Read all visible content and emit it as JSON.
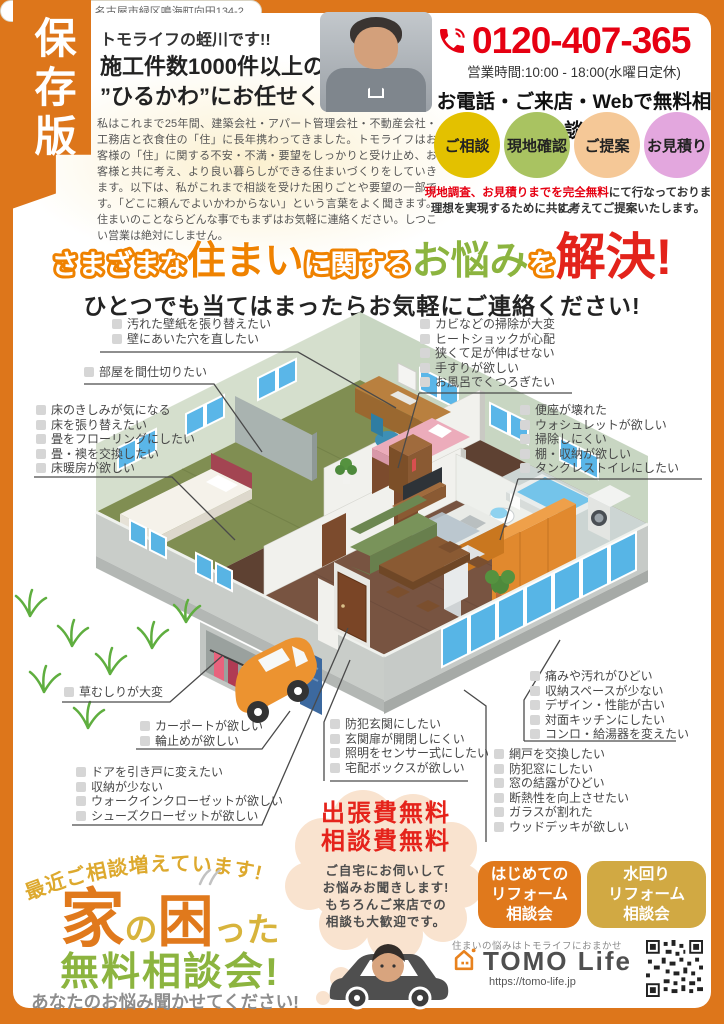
{
  "frame": {
    "save_label": "保存版"
  },
  "header": {
    "greeting": "トモライフの蛭川です!!",
    "headline_line1": "施工件数1000件以上の",
    "headline_line2": "”ひるかわ”にお任せください。",
    "paragraph": "私はこれまで25年間、建築会社・アパート管理会社・不動産会社・工務店と衣食住の「住」に長年携わってきました。トモライフはお客様の「住」に関する不安・不満・要望をしっかりと受け止め、お客様と共に考え、より良い暮らしができる住まいづくりをしていきます。以下は、私がこれまで相談を受けた困りごとや要望の一部です。「どこに頼んでよいかわからない」という言葉をよく聞きます。住まいのことならどんな事でもまずはお気軽に連絡ください。しつこい営業は絶対にしません。",
    "phone": "0120-407-365",
    "hours": "営業時間:10:00 - 18:00(水曜日定休)",
    "free_consult": "お電話・ご来店・Webで無料相談",
    "steps": [
      {
        "label": "ご相談",
        "color": "#e3c100"
      },
      {
        "label": "現地確認",
        "color": "#a9c361"
      },
      {
        "label": "ご提案",
        "color": "#f5c897"
      },
      {
        "label": "お見積り",
        "color": "#e3a7de"
      }
    ],
    "note_red": "現地調査、お見積りまでを完全無料",
    "note_rest": "にて行なっております。",
    "note_line2": "理想を実現するために共に考えてご提案いたします。"
  },
  "title": {
    "seg1": "さまざまな",
    "seg2": "住まい",
    "seg3": "に関する",
    "seg4": "お悩み",
    "seg5": "を",
    "seg6": "解決!",
    "subtitle": "ひとつでも当てはまったらお気軽にご連絡ください!"
  },
  "checklists": {
    "wall": [
      "汚れた壁紙を張り替えたい",
      "壁にあいた穴を直したい"
    ],
    "partition": [
      "部屋を間仕切りたい"
    ],
    "floor": [
      "床のきしみが気になる",
      "床を張り替えたい",
      "畳をフローリングにしたい",
      "畳・襖を交換したい",
      "床暖房が欲しい"
    ],
    "bath": [
      "カビなどの掃除が大変",
      "ヒートショックが心配",
      "狭くて足が伸ばせない",
      "手すりが欲しい",
      "お風呂でくつろぎたい"
    ],
    "toilet": [
      "便座が壊れた",
      "ウォシュレットが欲しい",
      "掃除しにくい",
      "棚・収納が欲しい",
      "タンクレストイレにしたい"
    ],
    "garden": [
      "草むしりが大変"
    ],
    "carport": [
      "カーポートが欲しい",
      "輪止めが欲しい"
    ],
    "storage": [
      "ドアを引き戸に変えたい",
      "収納が少ない",
      "ウォークインクローゼットが欲しい",
      "シューズクローゼットが欲しい"
    ],
    "entrance": [
      "防犯玄関にしたい",
      "玄関扉が開閉しにくい",
      "照明をセンサー式にしたい",
      "宅配ボックスが欲しい"
    ],
    "kitchen": [
      "痛みや汚れがひどい",
      "収納スペースが少ない",
      "デザイン・性能が古い",
      "対面キッチンにしたい",
      "コンロ・給湯器を変えたい"
    ],
    "window": [
      "網戸を交換したい",
      "防犯窓にしたい",
      "窓の結露がひどい",
      "断熱性を向上させたい",
      "ガラスが割れた",
      "ウッドデッキが欲しい"
    ]
  },
  "bottom": {
    "arc_text": "最近ご相談増えています!",
    "big1": "家",
    "big2": "の",
    "big3": "困",
    "big4": "った",
    "green_title": "無料相談会!",
    "gray_note": "あなたのお悩み聞かせてください!",
    "bubble_red1": "出張費無料",
    "bubble_red2": "相談費無料",
    "bubble_lines": [
      "ご自宅にお伺いして",
      "お悩みお聞きします!",
      "もちろんご来店での",
      "相談も大歓迎です。"
    ],
    "badge1_lines": [
      "はじめての",
      "リフォーム",
      "相談会"
    ],
    "badge2_lines": [
      "水回り",
      "リフォーム",
      "相談会"
    ],
    "logo_tagline": "住まいの悩みはトモライフにおまかせ",
    "logo_text": "TOMO Life",
    "url": "https://tomo-life.jp",
    "address": "〒458-0831 名古屋市緑区鳴海町向田134-2"
  },
  "colors": {
    "accent_orange": "#dd761b",
    "red": "#e60012",
    "green": "#8cb43f",
    "gold": "#d8b43c"
  }
}
